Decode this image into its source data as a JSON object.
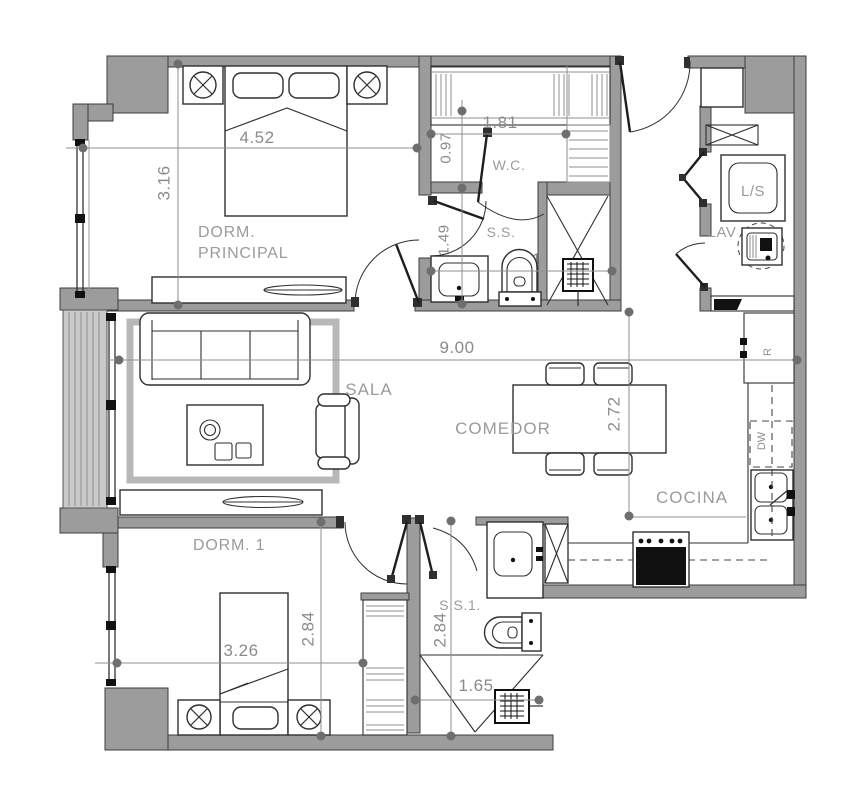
{
  "rooms": {
    "master_bedroom": {
      "line1": "DORM.",
      "line2": "PRINCIPAL"
    },
    "bedroom_1": {
      "label": "DORM. 1"
    },
    "living_room": {
      "label": "SALA"
    },
    "dining_room": {
      "label": "COMEDOR"
    },
    "kitchen": {
      "label": "COCINA"
    },
    "walk_in_closet": {
      "label": "W.C."
    },
    "master_bathroom": {
      "label": "S.S."
    },
    "bathroom_1": {
      "label": "S.S.1."
    },
    "laundry": {
      "label": "LAV"
    }
  },
  "appliances": {
    "washer_dryer": "L/S",
    "refrigerator": "R",
    "dishwasher": "DW"
  },
  "dimensions_m": {
    "master_bedroom_width": "4.52",
    "master_bedroom_depth": "3.16",
    "walk_in_closet_width": "1.81",
    "walk_in_closet_depth": "0.97",
    "master_bath_depth": "1.49",
    "master_bath_width": "2.41",
    "overall_width": "9.00",
    "dining_depth": "2.72",
    "bedroom_1_width": "3.26",
    "bedroom_1_depth": "2.84",
    "bathroom_1_depth": "2.84",
    "bathroom_1_width": "1.65"
  },
  "colors": {
    "wall_fill": "#9c9c9c",
    "wall_outline": "#3d3d3d",
    "line_dark": "#2f2f2f",
    "dim_gray": "#8b8b8b",
    "label_gray": "#9b9b9b",
    "rug_gray": "#b8b8b8",
    "appliance_black": "#111111",
    "glass_fill": "#c9c9c9"
  }
}
